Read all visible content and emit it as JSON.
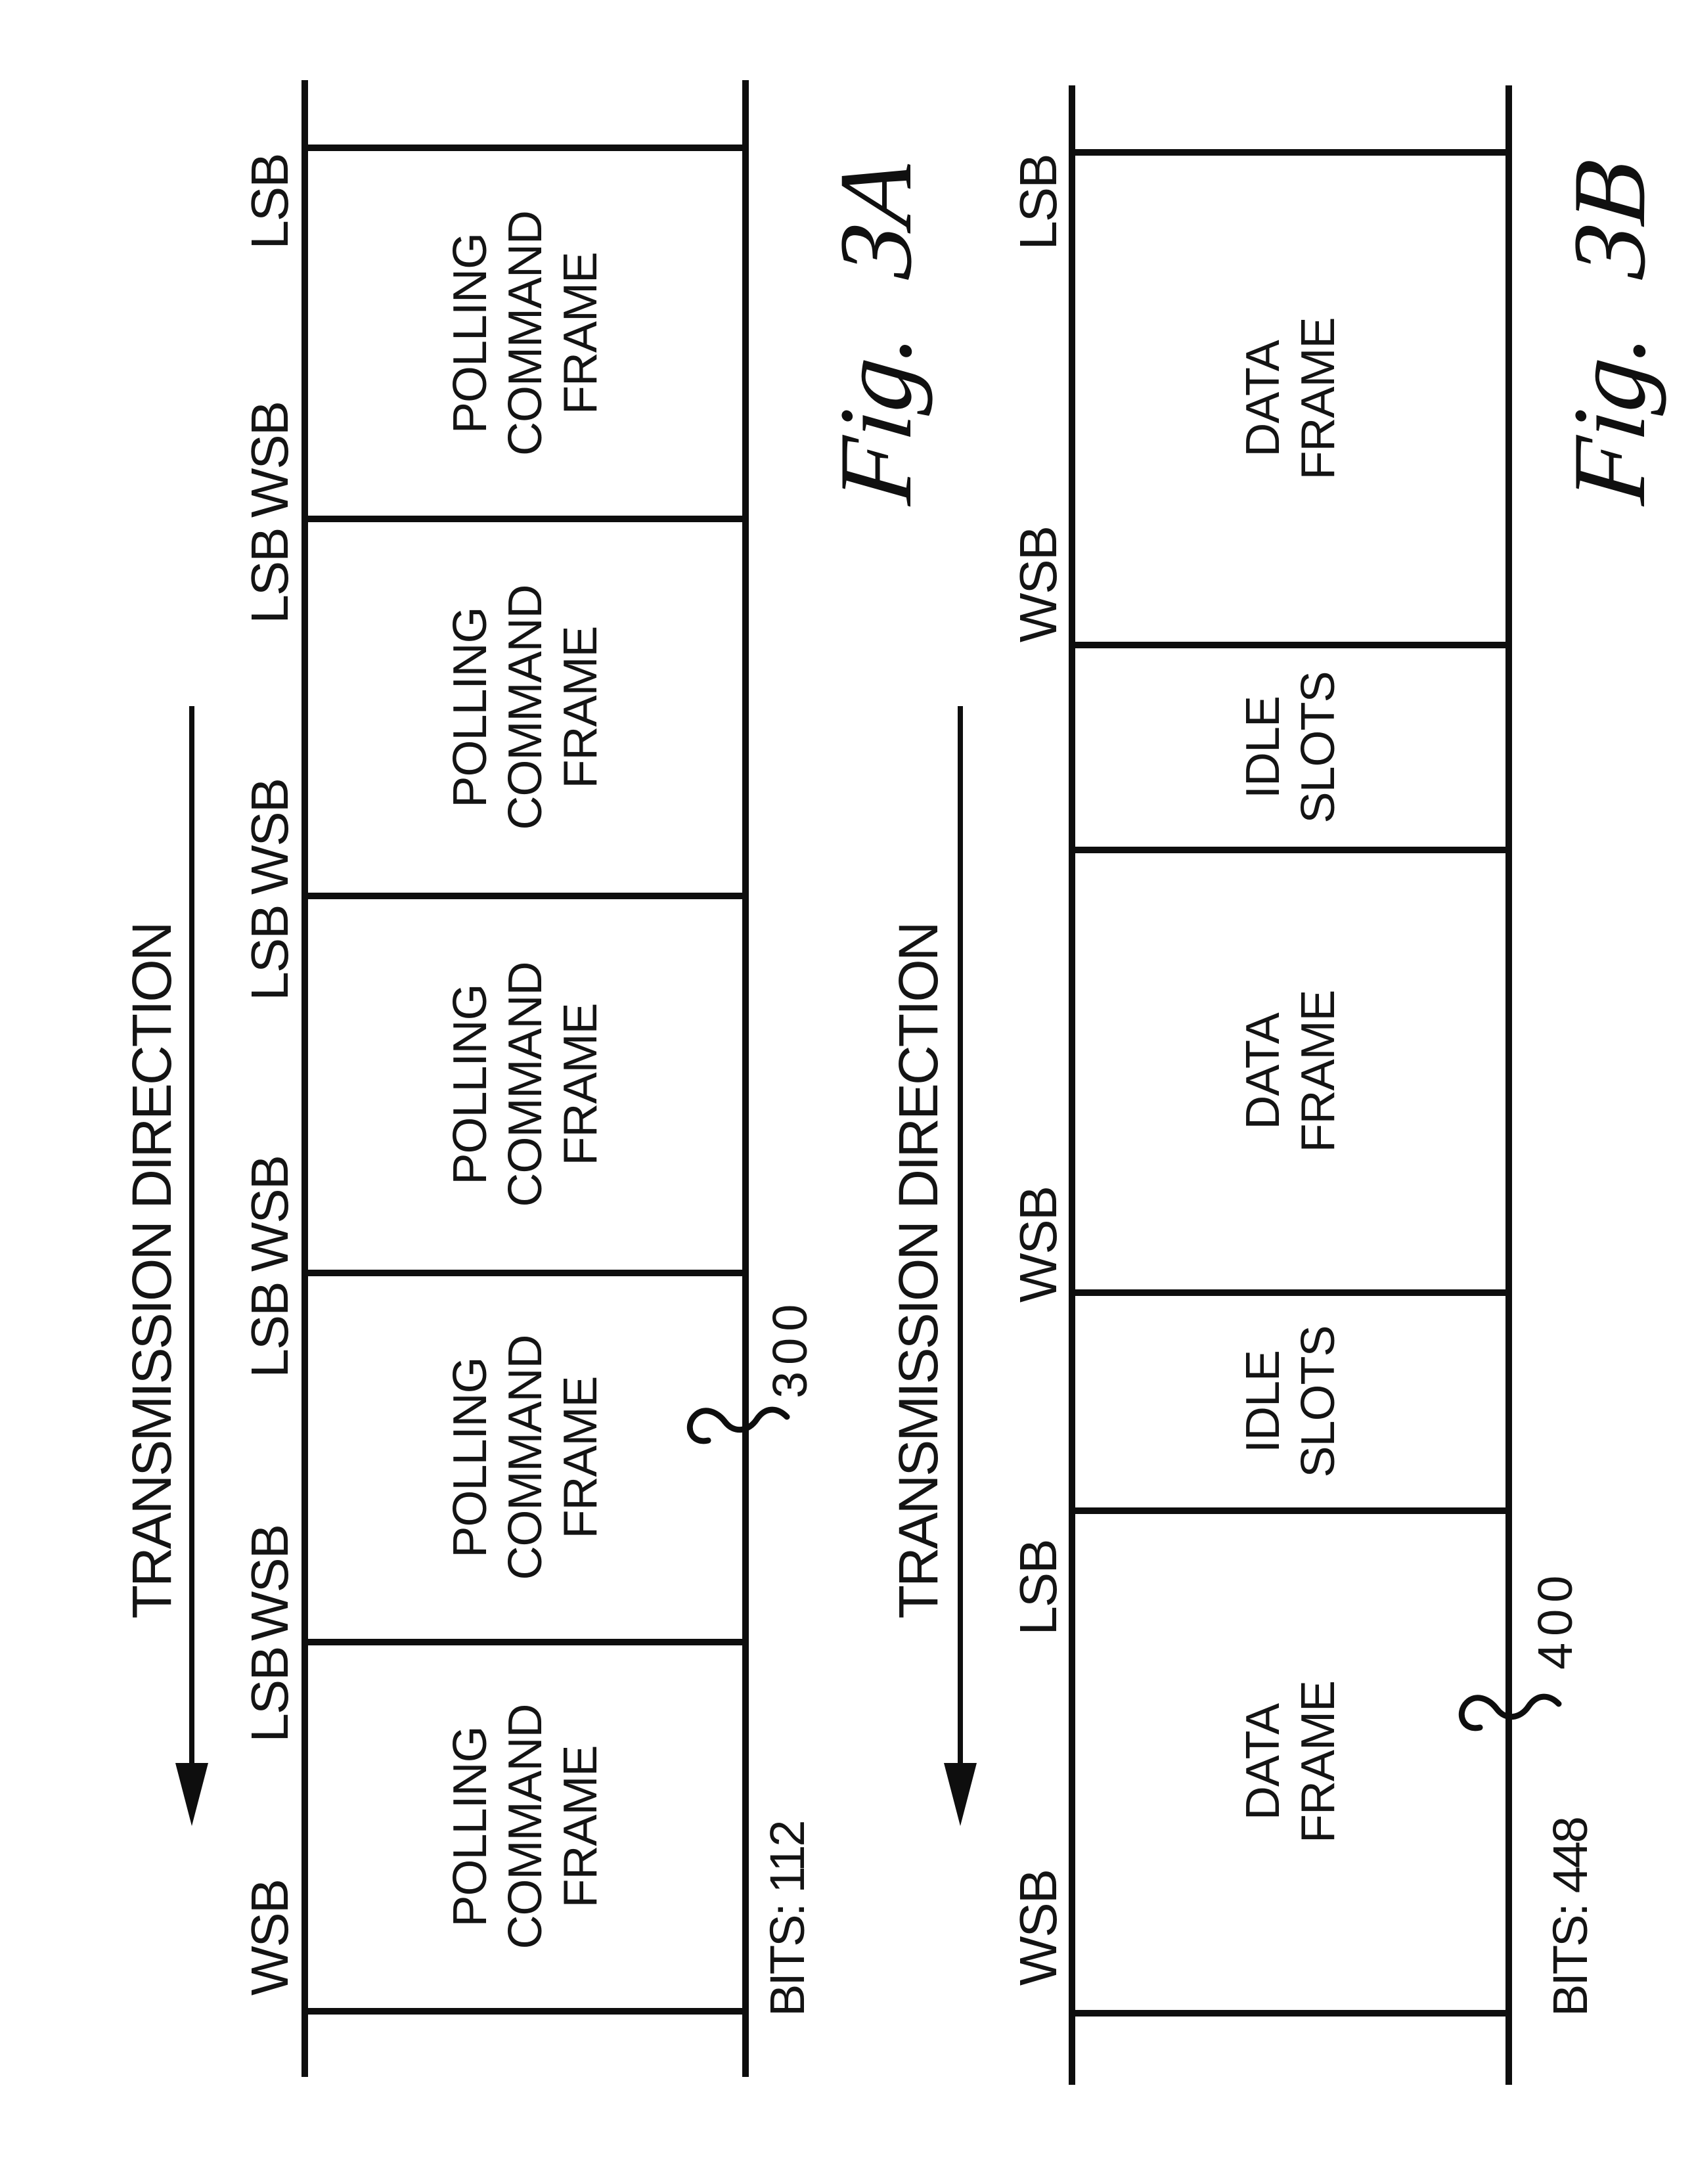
{
  "page": {
    "background": "#ffffff",
    "ink": "#0e0e0e"
  },
  "figures": [
    {
      "id": "3A",
      "title": "Fig. 3A",
      "transmission_label": "TRANSMISSION DIRECTION",
      "bits_label": "BITS: 112",
      "ref_number": "300",
      "frames": [
        {
          "lines": [
            "POLLING",
            "COMMAND",
            "FRAME"
          ]
        },
        {
          "lines": [
            "POLLING",
            "COMMAND",
            "FRAME"
          ]
        },
        {
          "lines": [
            "POLLING",
            "COMMAND",
            "FRAME"
          ]
        },
        {
          "lines": [
            "POLLING",
            "COMMAND",
            "FRAME"
          ]
        },
        {
          "lines": [
            "POLLING",
            "COMMAND",
            "FRAME"
          ]
        }
      ],
      "bit_labels": [
        {
          "text": "WSB"
        },
        {
          "text": "LSB"
        },
        {
          "text": "WSB"
        },
        {
          "text": "LSB"
        },
        {
          "text": "WSB"
        },
        {
          "text": "LSB"
        },
        {
          "text": "WSB"
        },
        {
          "text": "LSB"
        },
        {
          "text": "WSB"
        },
        {
          "text": "LSB"
        }
      ]
    },
    {
      "id": "3B",
      "title": "Fig. 3B",
      "transmission_label": "TRANSMISSION DIRECTION",
      "bits_label": "BITS: 448",
      "ref_number": "400",
      "frames": [
        {
          "lines": [
            "DATA",
            "FRAME"
          ]
        },
        {
          "lines": [
            "IDLE",
            "SLOTS"
          ]
        },
        {
          "lines": [
            "DATA",
            "FRAME"
          ]
        },
        {
          "lines": [
            "IDLE",
            "SLOTS"
          ]
        },
        {
          "lines": [
            "DATA",
            "FRAME"
          ]
        }
      ],
      "bit_labels": [
        {
          "text": "WSB"
        },
        {
          "text": "LSB"
        },
        {
          "text": "WSB"
        },
        {
          "text": "WSB"
        },
        {
          "text": "LSB"
        }
      ]
    }
  ]
}
